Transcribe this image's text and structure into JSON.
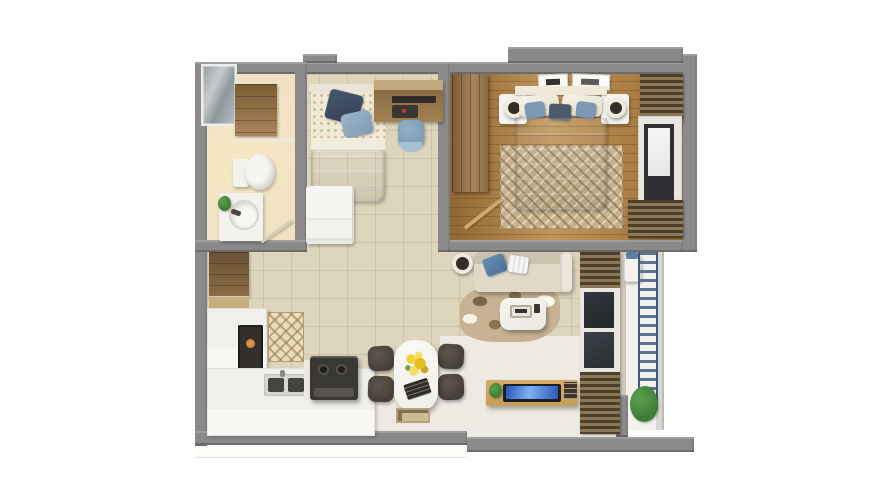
{
  "scene": {
    "type": "3d-apartment-floor-plan-render",
    "background": "#ffffff",
    "visible_text": "none"
  },
  "palette": {
    "wall_gray": "#8a8a8a",
    "tile_floor": "#ded5bd",
    "bath_floor": "#efe1c2",
    "wood_floor": "#b7894e",
    "slab_floor": "#eceae2",
    "balcony_floor": "#f2f1ec",
    "counter_white": "#f0efe9",
    "appliance_dark": "#3a3835",
    "chair_dark": "#474038",
    "chair_blue": "#7d9cb5",
    "sofa_beige": "#e0d9c6",
    "pillow_blue": "#4f7096",
    "bed_blue": "#8ba8bb",
    "linen_white": "#f2edde",
    "wood_furniture": "#96794c",
    "console_wood": "#c79d5c",
    "tv_screen_blue": "#2f62c8",
    "rug_tan": "#c7b393",
    "plant_green": "#3c7a36",
    "rack_blue": "#5e7390",
    "glass_gray": "#aeb6ba",
    "lamp_dark": "#332e28",
    "accent_orange": "#c97b2d",
    "flower_yellow": "#e9c832"
  },
  "rooms": [
    {
      "name": "bathroom",
      "furniture": [
        "shower-glass-enclosure",
        "wall-cabinet",
        "toilet",
        "washbasin-vanity",
        "plant",
        "door-leaf"
      ]
    },
    {
      "name": "bedroom-2",
      "furniture": [
        "single-bed",
        "blue-pillow",
        "navy-throw",
        "desk",
        "laptop",
        "desk-chair",
        "white-cabinet"
      ]
    },
    {
      "name": "master-bedroom",
      "furniture": [
        "wardrobe",
        "double-bed",
        "pillows",
        "blue-duvet",
        "nightstand-left",
        "nightstand-right",
        "table-lamp-left",
        "table-lamp-right",
        "herringbone-rug",
        "wall-art-frames",
        "window",
        "louver-blinds",
        "door-leaf"
      ]
    },
    {
      "name": "kitchen",
      "furniture": [
        "tall-cabinet",
        "l-shaped-counter",
        "built-in-oven",
        "backsplash-tiles",
        "double-basin-sink",
        "cooktop"
      ]
    },
    {
      "name": "dining-area",
      "furniture": [
        "dining-table",
        "chair-1",
        "chair-2",
        "chair-3",
        "chair-4",
        "yellow-flowers",
        "placemat",
        "doormat"
      ]
    },
    {
      "name": "living-area",
      "furniture": [
        "floor-lamp",
        "sofa",
        "blue-throw-pillow",
        "striped-pillow",
        "area-rug",
        "coffee-table",
        "serving-tray",
        "tv-console",
        "television",
        "books",
        "small-plant",
        "louver-window-wall"
      ]
    },
    {
      "name": "balcony",
      "furniture": [
        "washing-machine",
        "laundry-basket",
        "drying-rack",
        "potted-plant"
      ]
    }
  ]
}
